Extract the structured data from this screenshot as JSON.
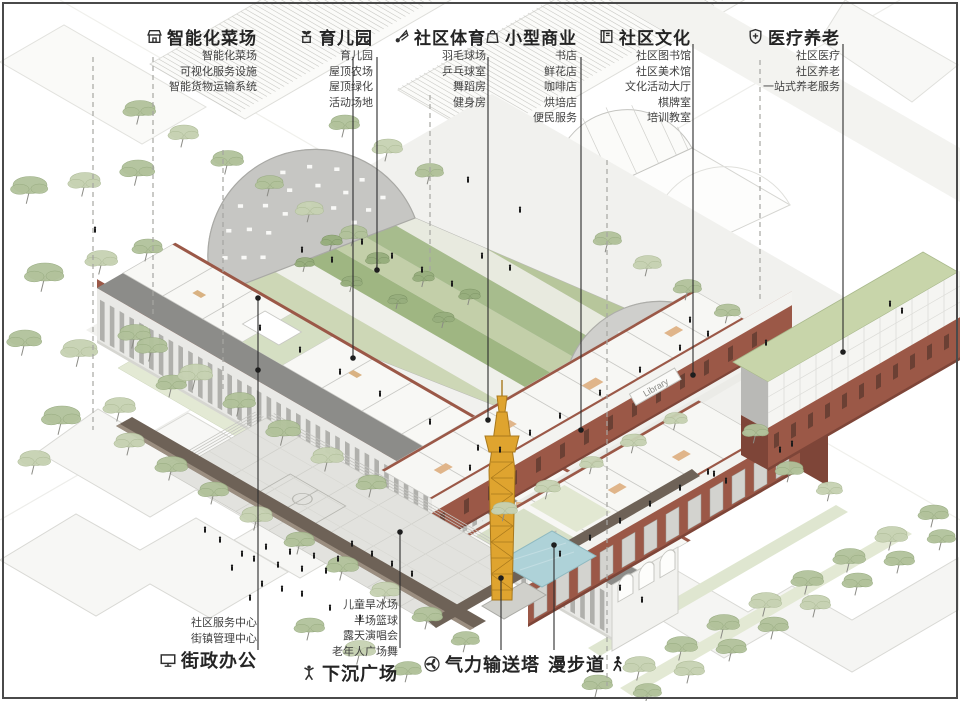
{
  "legend_top": [
    {
      "title": "智能化菜场",
      "icon": "market-stall-icon",
      "items": [
        "智能化菜场",
        "可视化服务设施",
        "智能货物运输系统"
      ]
    },
    {
      "title": "育儿园",
      "icon": "sprout-planter-icon",
      "items": [
        "育儿园",
        "屋顶农场",
        "屋顶绿化",
        "活动场地"
      ]
    },
    {
      "title": "社区体育",
      "icon": "shuttlecock-icon",
      "items": [
        "羽毛球场",
        "乒乓球室",
        "舞蹈房",
        "健身房"
      ]
    },
    {
      "title": "小型商业",
      "icon": "shopping-bag-icon",
      "items": [
        "书店",
        "鲜花店",
        "咖啡店",
        "烘培店",
        "便民服务"
      ]
    },
    {
      "title": "社区文化",
      "icon": "book-icon",
      "items": [
        "社区图书馆",
        "社区美术馆",
        "文化活动大厅",
        "棋牌室",
        "培训教室"
      ]
    },
    {
      "title": "医疗养老",
      "icon": "shield-cross-icon",
      "items": [
        "社区医疗",
        "社区养老",
        "一站式养老服务"
      ]
    }
  ],
  "legend_bottom": [
    {
      "title": "街政办公",
      "icon": "monitor-icon",
      "items": [
        "社区服务中心",
        "街镇管理中心"
      ]
    },
    {
      "title": "下沉广场",
      "icon": "dancing-person-icon",
      "items": [
        "儿童旱冰场",
        "半场篮球",
        "露天演唱会",
        "老年人广场舞"
      ]
    },
    {
      "title": "气力输送塔",
      "icon": "fan-icon",
      "items": []
    },
    {
      "title": "漫步道",
      "icon": "walking-person-icon",
      "items": []
    }
  ],
  "building_sign": "Library",
  "colors": {
    "brick": "#9b5847",
    "brick_dark": "#7e4538",
    "canopy_green": "#b2c29b",
    "lawn_green": "#a7bc8d",
    "tower_yellow": "#dfa42f",
    "pool_blue": "#aed2d8",
    "ink": "#2c2c2c"
  }
}
